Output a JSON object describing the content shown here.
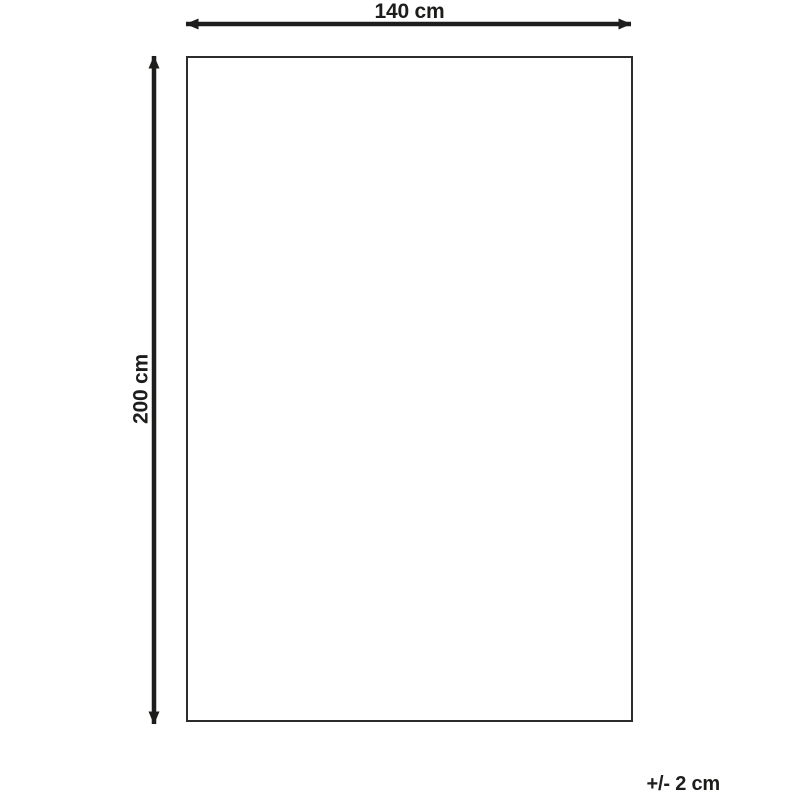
{
  "diagram": {
    "width_label": "140 cm",
    "height_label": "200 cm",
    "tolerance_label": "+/- 2 cm",
    "line_color": "#1d1d1b",
    "outline_color": "#2c2c2c",
    "background_color": "#ffffff"
  }
}
